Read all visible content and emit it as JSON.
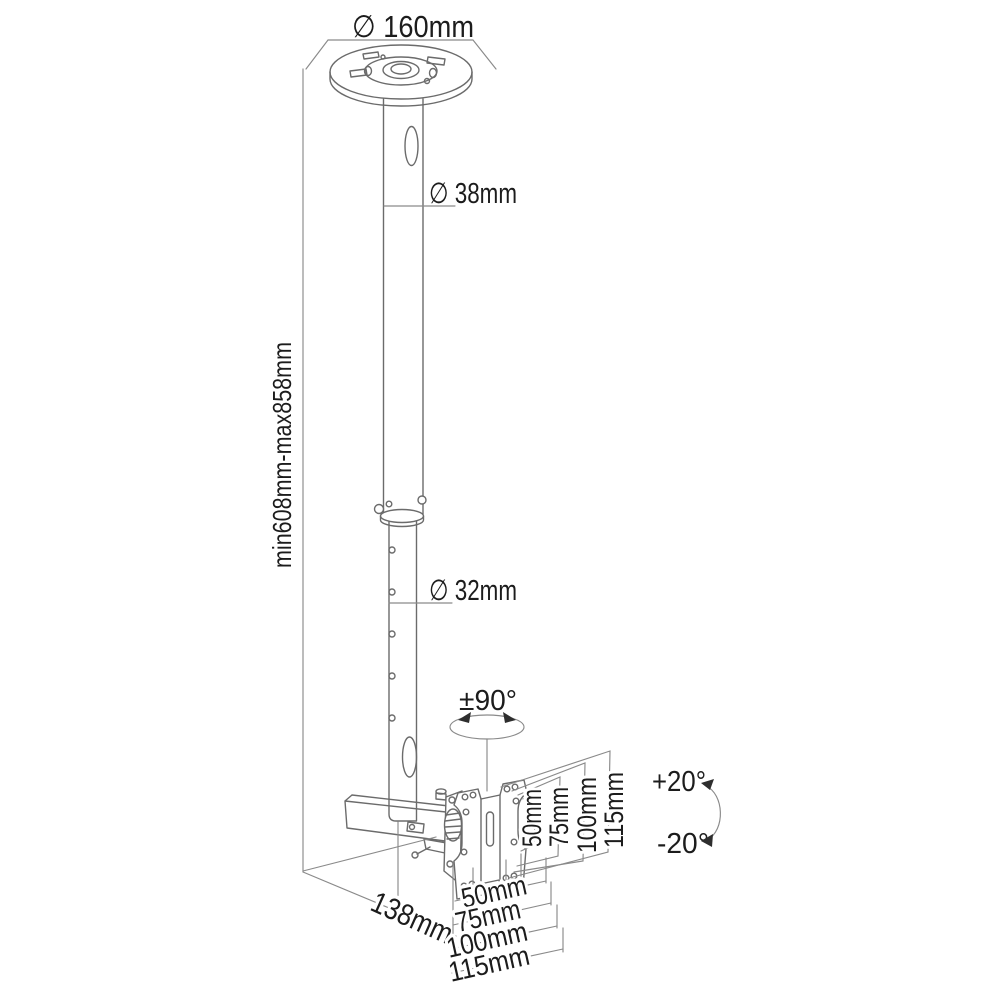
{
  "figure": {
    "type": "technical-diagram",
    "subject": "ceiling TV mount with telescopic pole, swivel and tilt",
    "colors": {
      "background": "#ffffff",
      "object_line": "#6b6b6b",
      "dim_line": "#8a8a8a",
      "text": "#1c1c1c"
    },
    "labels": {
      "plate_diameter": "∅ 160mm",
      "upper_tube_diameter": "∅ 38mm",
      "lower_tube_diameter": "∅ 32mm",
      "height_range": "min608mm-max858mm",
      "swivel": "±90°",
      "tilt_up": "+20°",
      "tilt_down": "-20°",
      "depth": "138mm",
      "vesa_vertical": [
        "50mm",
        "75mm",
        "100mm",
        "115mm"
      ],
      "vesa_horizontal": [
        "50mm",
        "75mm",
        "100mm",
        "115mm"
      ]
    }
  }
}
